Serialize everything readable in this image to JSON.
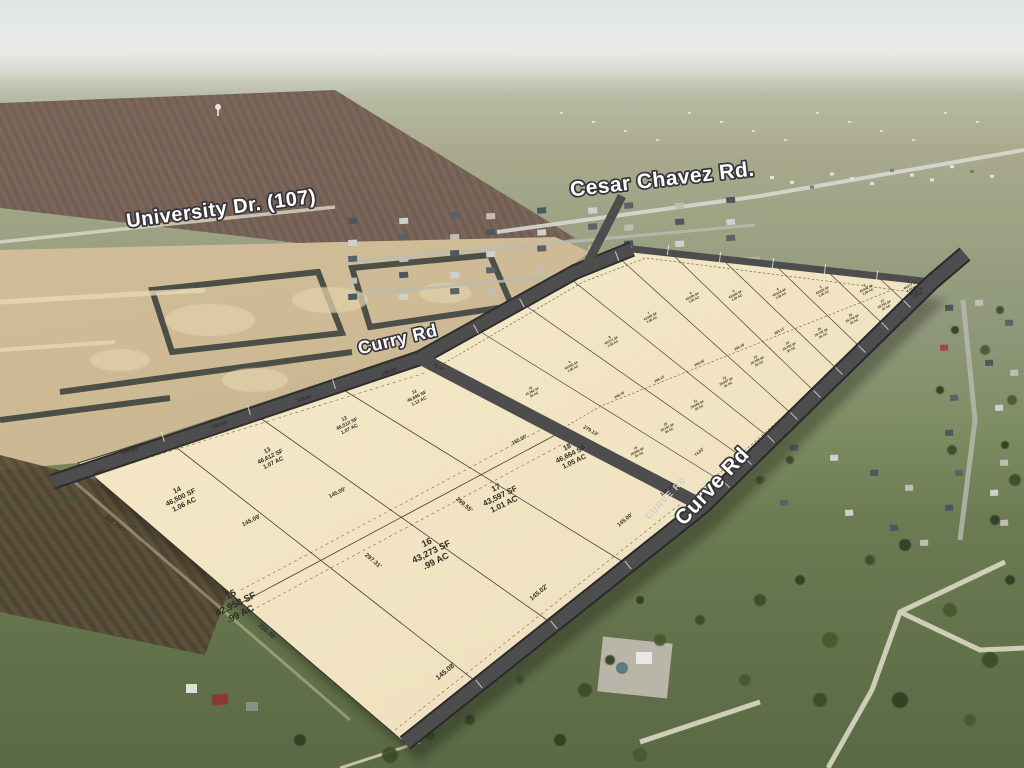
{
  "road_labels": {
    "university": "University Dr. (107)",
    "cesar_chavez": "Cesar Chavez Rd.",
    "curry": "Curry Rd",
    "curve": "Curve Rd",
    "curve_small": "CURVE RD"
  },
  "plat": {
    "large_lots": [
      {
        "number": "11",
        "sf": "46,695 SF",
        "ac": "1.12 AC"
      },
      {
        "number": "12",
        "sf": "46,512 SF",
        "ac": "1.07 AC"
      },
      {
        "number": "13",
        "sf": "46,612 SF",
        "ac": "1.07 AC"
      },
      {
        "number": "14",
        "sf": "46,500 SF",
        "ac": "1.06 AC"
      },
      {
        "number": "15",
        "sf": "42,958 SF",
        "ac": ".99 AC"
      },
      {
        "number": "16",
        "sf": "43,273 SF",
        "ac": ".99 AC"
      },
      {
        "number": "17",
        "sf": "43,597 SF",
        "ac": "1.01 AC"
      },
      {
        "number": "18",
        "sf": "46,664 SF",
        "ac": "1.05 AC"
      }
    ],
    "small_lots_top": [
      {
        "number": "10",
        "sf": "41,382 SF",
        "ac": ".95 AC"
      },
      {
        "number": "9",
        "sf": "43,560 SF",
        "ac": "1.00 AC"
      },
      {
        "number": "8",
        "sf": "43,571 SF",
        "ac": "1.00 AC"
      },
      {
        "number": "7",
        "sf": "43,583 SF",
        "ac": "1.00 AC"
      },
      {
        "number": "6",
        "sf": "43,595 SF",
        "ac": "1.00 AC"
      },
      {
        "number": "5",
        "sf": "43,606 SF",
        "ac": "1.00 AC"
      },
      {
        "number": "4",
        "sf": "43,618 SF",
        "ac": "1.00 AC"
      },
      {
        "number": "3",
        "sf": "43,630 SF",
        "ac": "1.00 AC"
      },
      {
        "number": "2",
        "sf": "43,642 SF",
        "ac": "1.00 AC"
      },
      {
        "number": "1",
        "sf": "44,977 SF",
        "ac": "1.03 AC"
      }
    ],
    "small_lots_bottom": [
      {
        "number": "19",
        "sf": "39,846 SF",
        "ac": ".91 AC"
      },
      {
        "number": "20",
        "sf": "39,151 SF",
        "ac": ".90 AC"
      },
      {
        "number": "21",
        "sf": "39,686 SF",
        "ac": ".91 AC"
      },
      {
        "number": "22",
        "sf": "39,697 SF",
        "ac": ".91 AC"
      },
      {
        "number": "23",
        "sf": "39,709 SF",
        "ac": ".91 AC"
      },
      {
        "number": "24",
        "sf": "39,720 SF",
        "ac": ".91 AC"
      },
      {
        "number": "25",
        "sf": "39,732 SF",
        "ac": ".91 AC"
      },
      {
        "number": "26",
        "sf": "39,744 SF",
        "ac": ".91 AC"
      },
      {
        "number": "27",
        "sf": "39,755 SF",
        "ac": ".91 AC"
      },
      {
        "number": "28",
        "sf": "40,167 SF",
        "ac": ".92 AC"
      }
    ],
    "dimensions": [
      "144.99'",
      "146.00'",
      "146.00'",
      "146.00'",
      "302.77'",
      "295.08'",
      "297.31'",
      "299.55'",
      "279.13'",
      "145.09'",
      "145.00'",
      "165.00'",
      "145.08'",
      "145.02'",
      "145.00'",
      "122.14'",
      "74.52'",
      "44.83'",
      "45.00'",
      "248.79'",
      "249.12'",
      "249.45'",
      "249.78'",
      "250.11'"
    ]
  },
  "colors": {
    "plat_fill": "#f2e4c1",
    "road_band": "#4d4d4d",
    "lot_line": "#4a4336",
    "label_fill": "#ffffff"
  }
}
